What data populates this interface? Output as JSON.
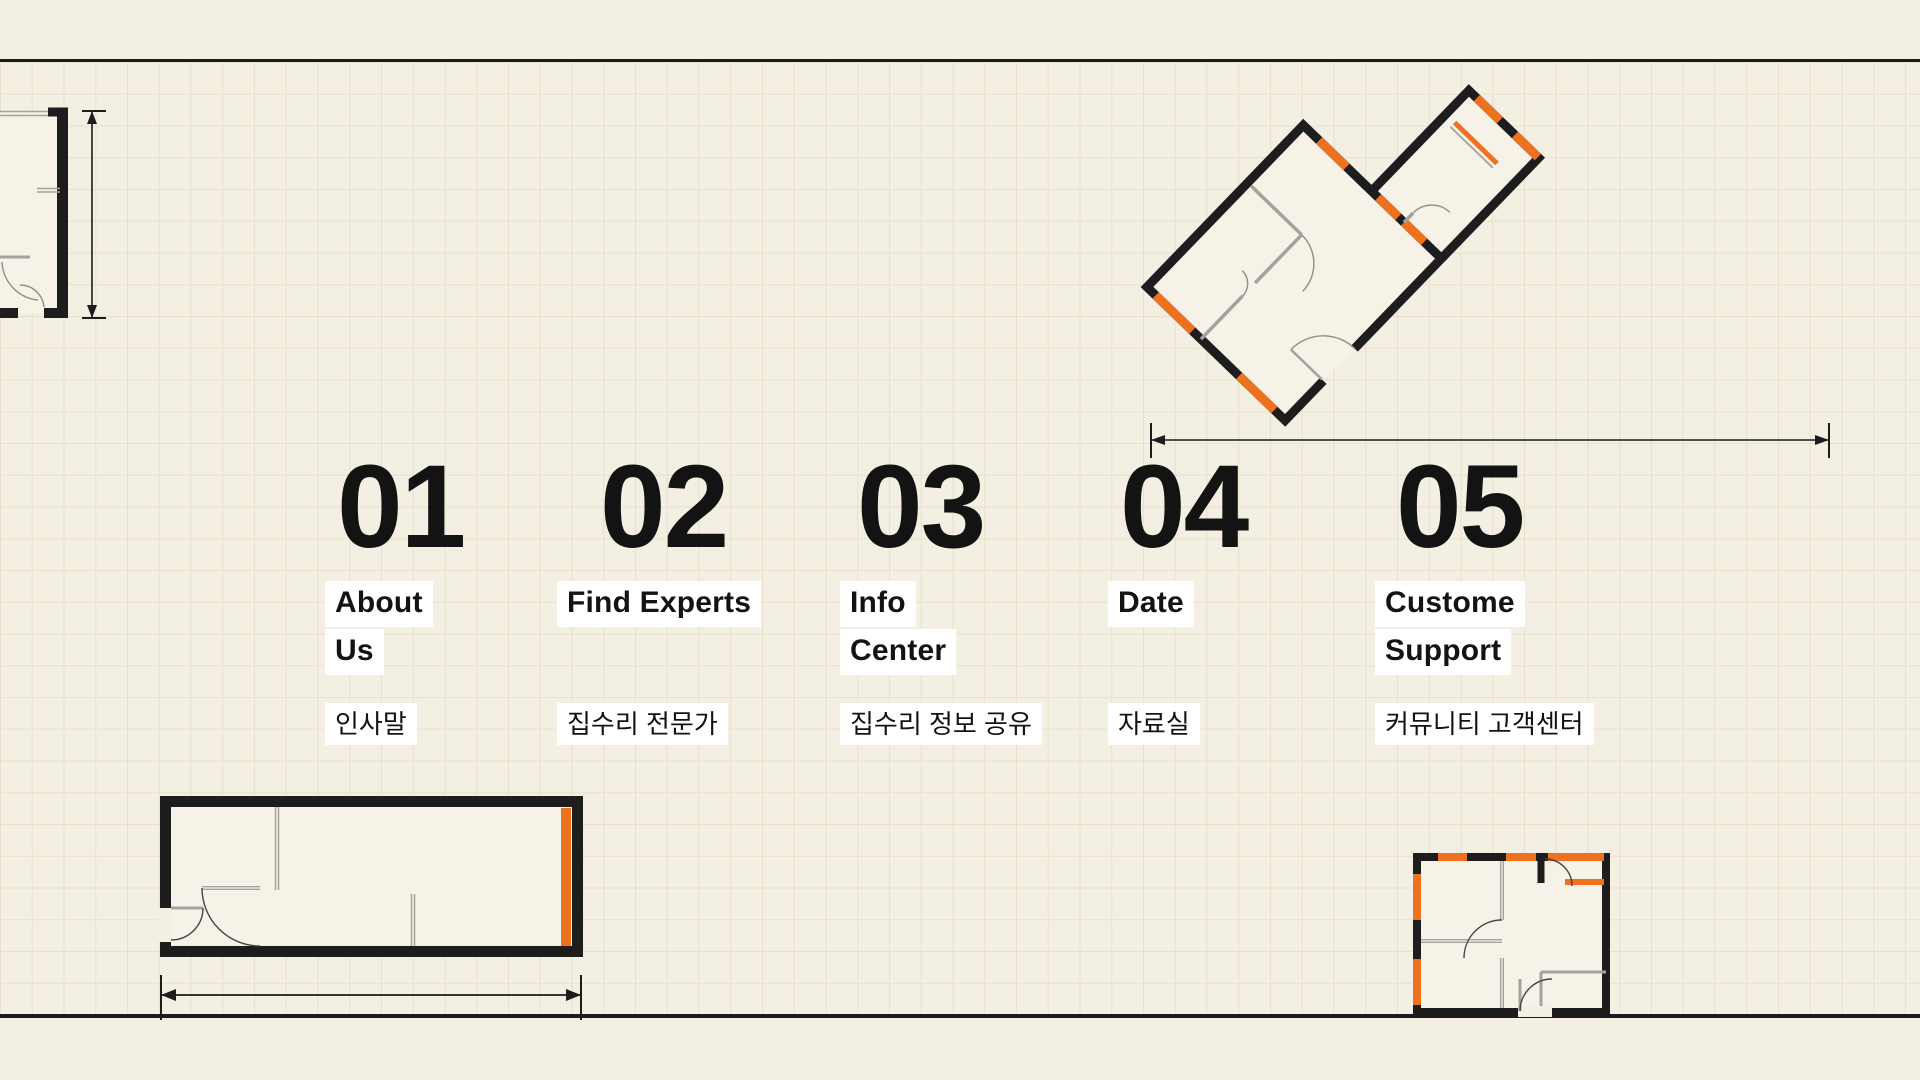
{
  "page": {
    "background_color": "#f3efe3",
    "accent_orange": "#ee7120",
    "wall_black": "#1d1d1d",
    "partition_gray": "#a3a39d",
    "highlight_white": "#ffffff",
    "text_color": "#131313"
  },
  "menu": {
    "items": [
      {
        "number": "01",
        "label_lines": [
          "About",
          "Us"
        ],
        "subtitle": "인사말"
      },
      {
        "number": "02",
        "label_lines": [
          "Find Experts"
        ],
        "subtitle": "집수리 전문가"
      },
      {
        "number": "03",
        "label_lines": [
          "Info",
          "Center"
        ],
        "subtitle": "집수리 정보 공유"
      },
      {
        "number": "04",
        "label_lines": [
          "Date"
        ],
        "subtitle": "자료실"
      },
      {
        "number": "05",
        "label_lines": [
          "Custome",
          "Support"
        ],
        "subtitle": "커뮤니티 고객센터"
      }
    ]
  }
}
